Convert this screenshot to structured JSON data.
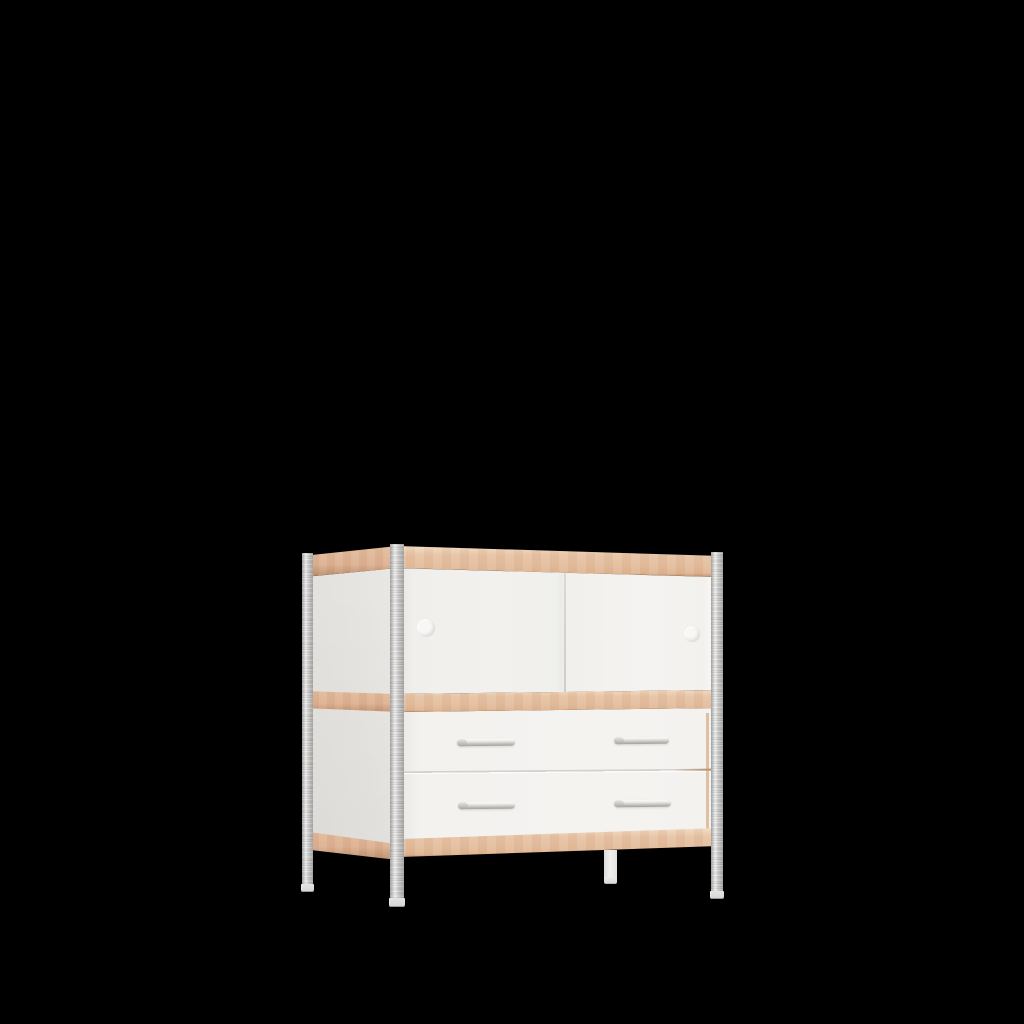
{
  "image": {
    "kind": "3d-product-render",
    "subject": "Modular sideboard cabinet: upper compartment with two white sliding doors (round finger holes), lower section with two drawers and metal bar handles, beech edge bands, four slotted galvanized-steel posts as legs",
    "background": "solid black"
  },
  "cabinet": {
    "sliding_doors": 2,
    "finger_holes": 2,
    "drawers": 2,
    "drawer_handles": 4,
    "legs": 4
  },
  "colors": {
    "bg": "#000000",
    "beech-top": "#e7c3a4",
    "beech-mid": "#e4be9e",
    "beech-bottom": "#e0b591",
    "beech-side": "#deb293",
    "beech-edge-dark": "#b98e6c",
    "beech-edge-light": "#f1dbc3",
    "door-left": "#f0efec",
    "door-right": "#f4f3f1",
    "side-white": "#ebe9e6",
    "drawer-white": "#f3f2ef",
    "seam": "#d3d1cf",
    "post-light": "#e8e7e6",
    "post-dark": "#acabaa",
    "chrome-light": "#fbfbfa",
    "chrome-dark": "#a5a19d",
    "leg-white": "#f1f0ee",
    "foot": "#d5d4d3"
  }
}
